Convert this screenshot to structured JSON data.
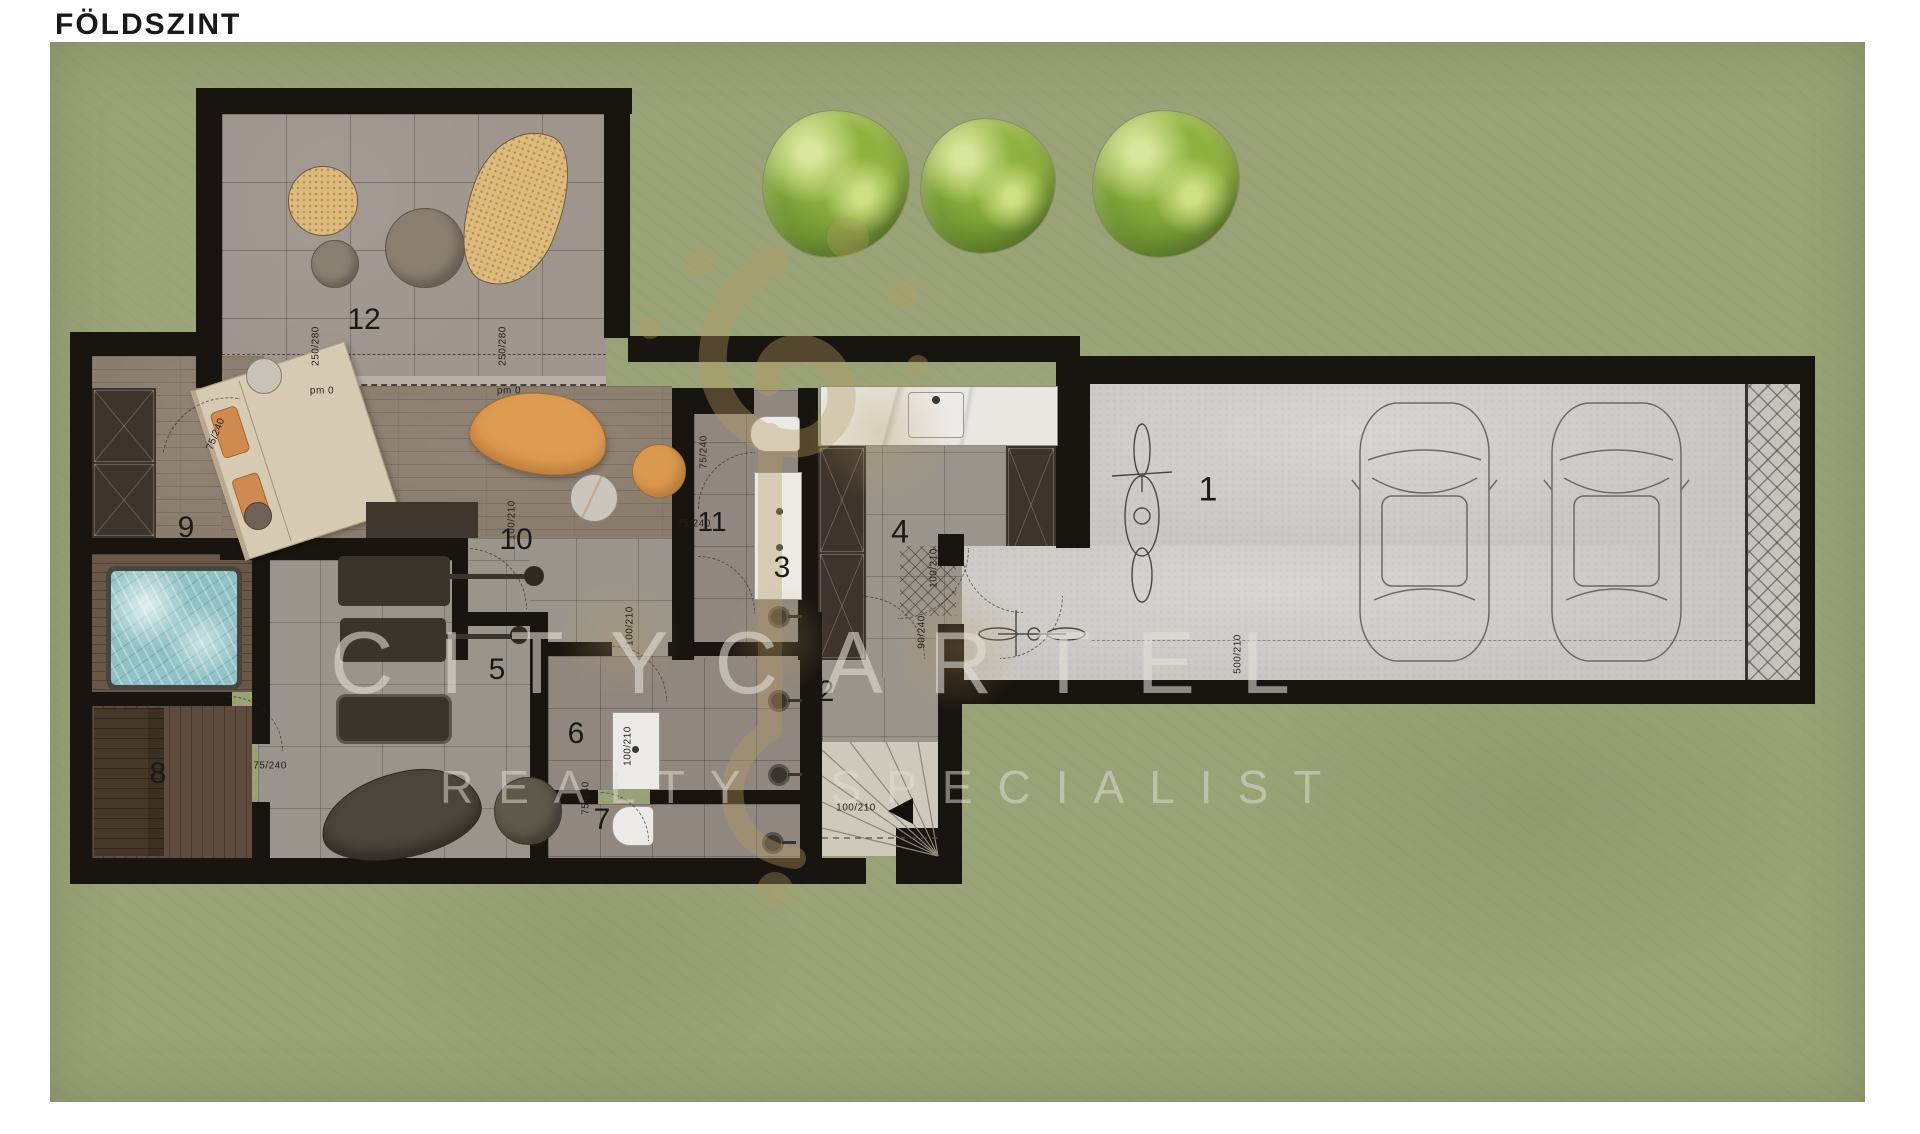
{
  "title": "FÖLDSZINT",
  "watermark": {
    "brand": "CITYCARTEL",
    "tagline": "REALTY SPECIALIST"
  },
  "colors": {
    "garden": "#99a377",
    "wall": "#18140f",
    "gold": "#b49a62",
    "water": "#8fc2c4",
    "concrete": "#c9c7c3"
  },
  "rooms": [
    {
      "number": "1",
      "x": 1208,
      "y": 490,
      "size": 34
    },
    {
      "number": "2",
      "x": 826,
      "y": 692,
      "size": 30
    },
    {
      "number": "3",
      "x": 782,
      "y": 568,
      "size": 30
    },
    {
      "number": "4",
      "x": 900,
      "y": 532,
      "size": 32
    },
    {
      "number": "5",
      "x": 497,
      "y": 670,
      "size": 30
    },
    {
      "number": "6",
      "x": 576,
      "y": 734,
      "size": 30
    },
    {
      "number": "7",
      "x": 602,
      "y": 820,
      "size": 30
    },
    {
      "number": "8",
      "x": 158,
      "y": 774,
      "size": 30
    },
    {
      "number": "9",
      "x": 186,
      "y": 528,
      "size": 30
    },
    {
      "number": "10",
      "x": 516,
      "y": 540,
      "size": 30
    },
    {
      "number": "11",
      "x": 712,
      "y": 522,
      "size": 28
    },
    {
      "number": "12",
      "x": 364,
      "y": 320,
      "size": 30
    }
  ],
  "dimensions": [
    {
      "text": "250/280",
      "x": 316,
      "y": 346,
      "rot": -90
    },
    {
      "text": "250/280",
      "x": 503,
      "y": 346,
      "rot": -90
    },
    {
      "text": "pm 0",
      "x": 322,
      "y": 391,
      "rot": 0
    },
    {
      "text": "pm 0",
      "x": 509,
      "y": 391,
      "rot": 0
    },
    {
      "text": "75/240",
      "x": 216,
      "y": 434,
      "rot": -68
    },
    {
      "text": "75/240",
      "x": 704,
      "y": 452,
      "rot": -90
    },
    {
      "text": "75/240",
      "x": 694,
      "y": 524,
      "rot": 0
    },
    {
      "text": "90/240",
      "x": 922,
      "y": 632,
      "rot": -90
    },
    {
      "text": "100/210",
      "x": 512,
      "y": 520,
      "rot": -90
    },
    {
      "text": "100/210",
      "x": 934,
      "y": 568,
      "rot": -90
    },
    {
      "text": "100/210",
      "x": 630,
      "y": 626,
      "rot": -90
    },
    {
      "text": "100/210",
      "x": 628,
      "y": 746,
      "rot": -90
    },
    {
      "text": "75/240",
      "x": 586,
      "y": 798,
      "rot": -90
    },
    {
      "text": "75/240",
      "x": 270,
      "y": 766,
      "rot": 0
    },
    {
      "text": "100/210",
      "x": 856,
      "y": 808,
      "rot": 0
    },
    {
      "text": "500/210",
      "x": 1238,
      "y": 654,
      "rot": -90
    }
  ],
  "trees": [
    {
      "x": 836,
      "y": 184,
      "s": 146
    },
    {
      "x": 988,
      "y": 186,
      "s": 134
    },
    {
      "x": 1166,
      "y": 184,
      "s": 146
    }
  ]
}
